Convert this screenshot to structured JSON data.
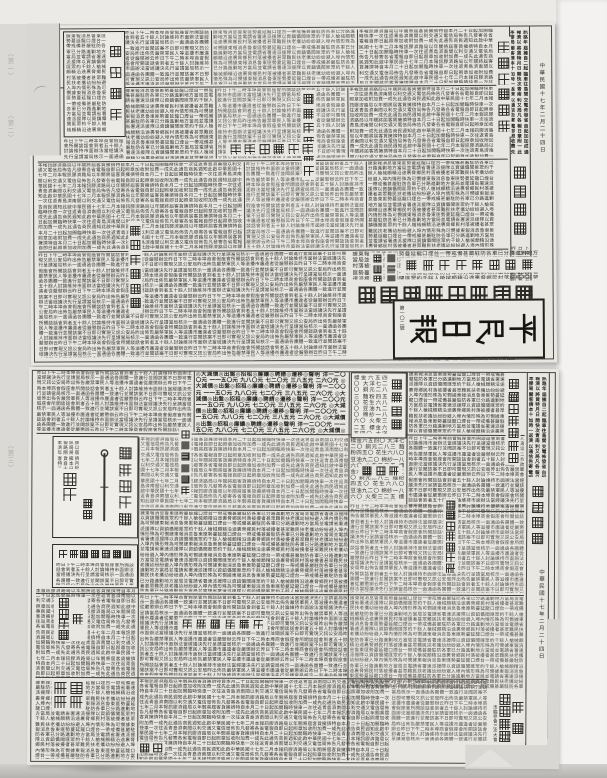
{
  "doc": {
    "masthead": {
      "title": "平民日報",
      "issue": "第一〇二號",
      "date": "中華民國十七年二月二十四日",
      "publisher": "本報發行所膠澳商埠 電話一五一號 每份售銅元四枚 廣告價目面議"
    },
    "running_header": {
      "title": "平民日報",
      "date": "中華民國十七年二月二十四日"
    },
    "upper_page": {
      "headline": {
        "kicker": "戰事仍在激烈進行",
        "main": "魯東匪氛進犯龍口",
        "sub1": "進攻龍口",
        "sub2": "激戰進行"
      },
      "accents": {
        "a1": "膠濟路局要聞",
        "a2": "本埠新聞紀要",
        "a3": "國內要聞彙誌",
        "a4": "時局消息種種",
        "box_label": "緊要啟事"
      }
    },
    "lower_page": {
      "sections": {
        "hangqing": "每日行情",
        "lunchuanqi": "輪船期",
        "qishi": "啟事"
      },
      "ads": {
        "lantern_line": "正月十五鬧",
        "lantern_sub": "元宵",
        "price": "一元",
        "mgmt": "電氣事務管理所",
        "school": "專招插班生",
        "notice": "遺失聲明"
      },
      "headline": {
        "kicker": "市臨參會三次大會",
        "main": "路燈施行規程"
      },
      "accents": {
        "a5": "總商會昨開大會",
        "a6": "青年會昨開大會",
        "a7": "本埠緊要新聞",
        "a8": "市政籌備消息"
      },
      "listings": "◎大減價◎出盤◎招租◎廉讓◎聘請◎遷移◎聲明 洋一二〇〇元 一一五〇元 九八〇元 七二〇元 三八五元 二六〇元 ",
      "hangqing_rows": "標金六五四〇 大洋七二〇 銅元二八三 麵粉四五〇 花生六八〇 豆油九二〇 棉紗一八六〇 火柴三二五 "
    },
    "margin_marks": {
      "m1": "（第一）",
      "m2": "（第二）",
      "m3": "（第三）"
    },
    "filler": {
      "f1": "昨日下午二時本埠商會假座會所開談話會到者五十餘人討論維持市面辦法當經議決先行呈請當局核示一面通函各團體一致進行並聞該案不日即可實現又訊公安局昨出佈告嚴禁軍民人等滋擾市廛違者從嚴懲辦云",
      "f2": "據東報消息魯東匪勢蔓延龍口煙台一帶戒備甚嚴駐防各軍已分路進剿地方當局並電請省署速派援隊以資鎮懾聞匪眾約千餘人槍械頗精沿途裹脅鄉民村落被擾者甚眾難民扶老攜幼紛紛避入埠內情形殊為可憫",
      "f3": "本報訊膠濟路局以年關將屆客貨擁擠特自本月二十日起加開臨時快車一次往返青島濟南間以利交通又電信局佈告凡發寄各省電報自即日起照章加收附加費一成先此通告商民週知此啟中華民國十七年二月"
    }
  }
}
